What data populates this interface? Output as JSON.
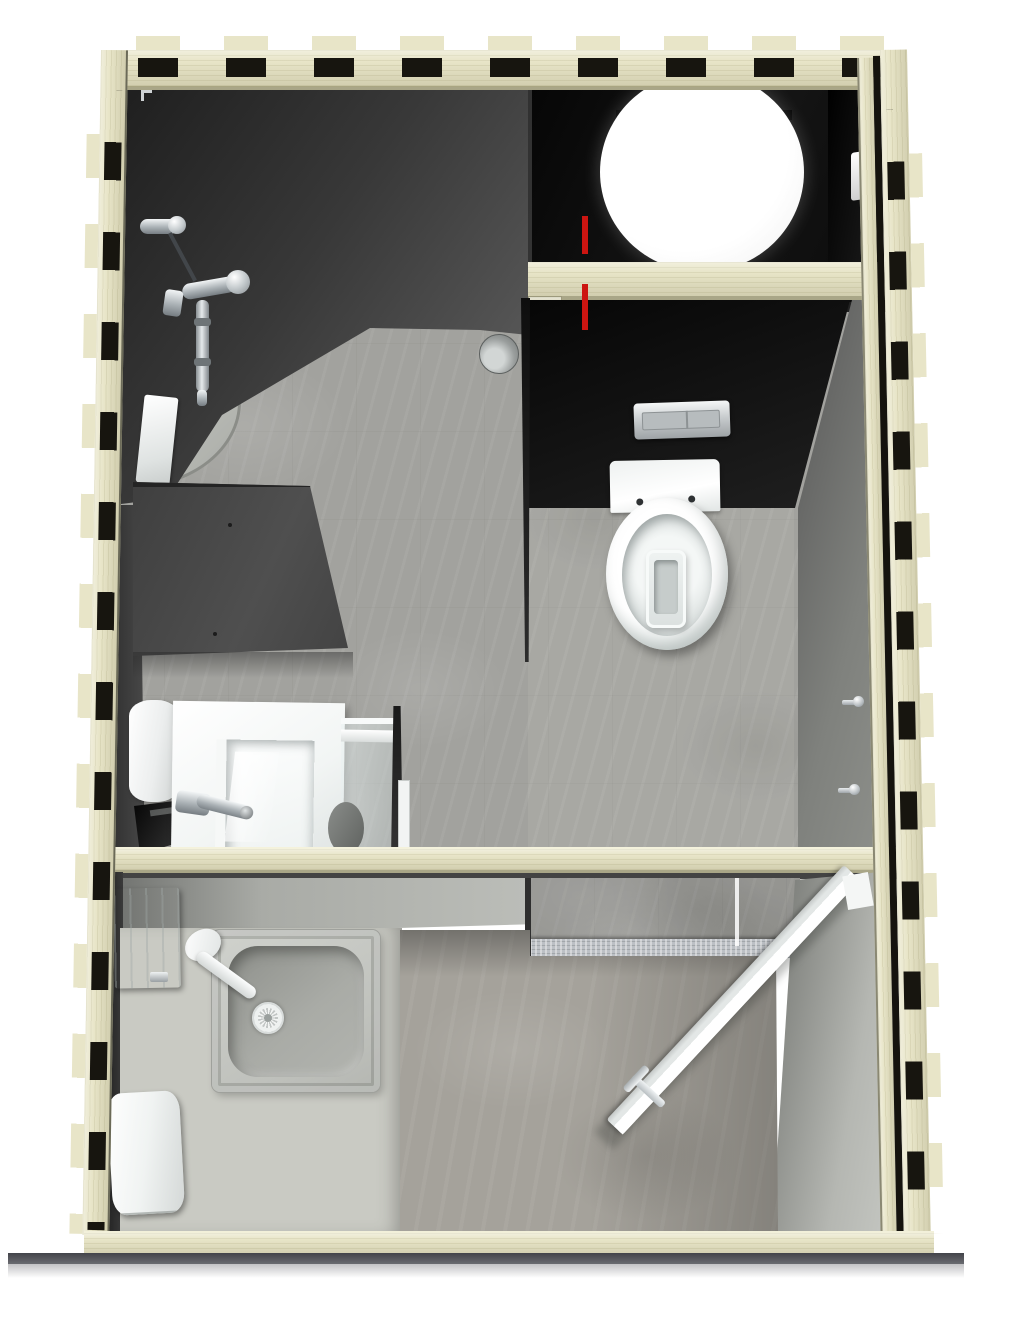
{
  "scene": {
    "title": "Top-down 3D cutaway rendering of a prefabricated plywood sanitary / bathroom module",
    "view": "plan view from above, photorealistic render, no visible text",
    "structure": {
      "frame": "interlocking CNC-cut plywood beams with finger-joint tabs and notch holes on all four sides",
      "beams": [
        "top-beam",
        "left-beam",
        "right-inner-plank",
        "right-beam",
        "bottom-beam",
        "cross-beam-under-boiler",
        "mid-wall-top-beam"
      ]
    },
    "rooms": [
      {
        "name": "shower-room",
        "position": "top-left",
        "fixtures": [
          "hand-shower-holder",
          "shower-hose",
          "shower-mixer-arm",
          "shower-rail",
          "curved-shower-tray",
          "floor-drain",
          "dark-partition-panel",
          "wall-light-panel"
        ]
      },
      {
        "name": "technical-compartment",
        "position": "top-right",
        "fixtures": [
          "water-boiler-cylinder",
          "red-supply-pipes",
          "ceiling-brackets",
          "gloss-black-service-wall"
        ]
      },
      {
        "name": "wc-area",
        "position": "middle-right",
        "fixtures": [
          "wall-hung-toilet",
          "chrome-flush-plate",
          "coat-hook",
          "coat-hook"
        ]
      },
      {
        "name": "washbasin-area",
        "position": "middle-left",
        "fixtures": [
          "square-washbasin",
          "basin-mixer-tap",
          "basin-drain",
          "soap-dispenser",
          "waste-bin",
          "glass-partition",
          "floor-waste-half-round"
        ]
      },
      {
        "name": "entry-room",
        "position": "bottom",
        "fixtures": [
          "utility-shower-tray",
          "tray-drain",
          "white-lever-tap",
          "paper-towel-dispenser",
          "soap-dispenser",
          "open-door",
          "door-handle",
          "threshold-step",
          "raised-platform"
        ]
      }
    ]
  },
  "colors": {
    "bg": "#ffffff",
    "wood": "#e8e5c8",
    "woodEdge": "#a9a687",
    "notch": "#17150f",
    "wallDark": "#3c3c3c",
    "black": "#0c0c0c",
    "stone": "#a2a29e",
    "concrete": "#a5a29b",
    "platform": "#c9cac3",
    "trayBowl": "#9b9d98",
    "white": "#ffffff",
    "chrome": "#aeb4b8",
    "red": "#cc1511",
    "shadow": "#43444a"
  }
}
